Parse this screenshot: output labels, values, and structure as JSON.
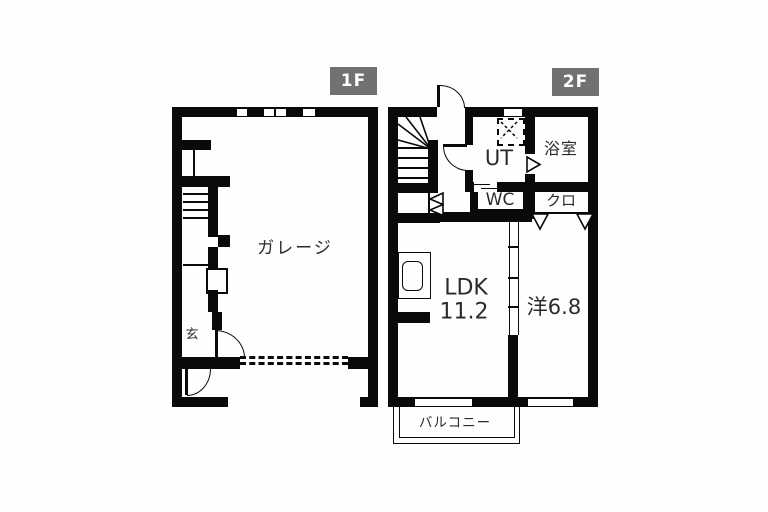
{
  "colors": {
    "wall": "#0a0a0a",
    "background": "#fefefe",
    "floor_tag_bg": "#717171",
    "floor_tag_text": "#ffffff",
    "room_text": "#2b2b2b"
  },
  "f1": {
    "tag": "1F",
    "garage": "ガレージ",
    "entrance": "玄"
  },
  "f2": {
    "tag": "2F",
    "ut": "UT",
    "bath": "浴室",
    "wc": "WC",
    "closet": "クロ",
    "ldk1": "LDK",
    "ldk2": "11.2",
    "bedroom": "洋6.8",
    "balcony": "バルコニー"
  }
}
